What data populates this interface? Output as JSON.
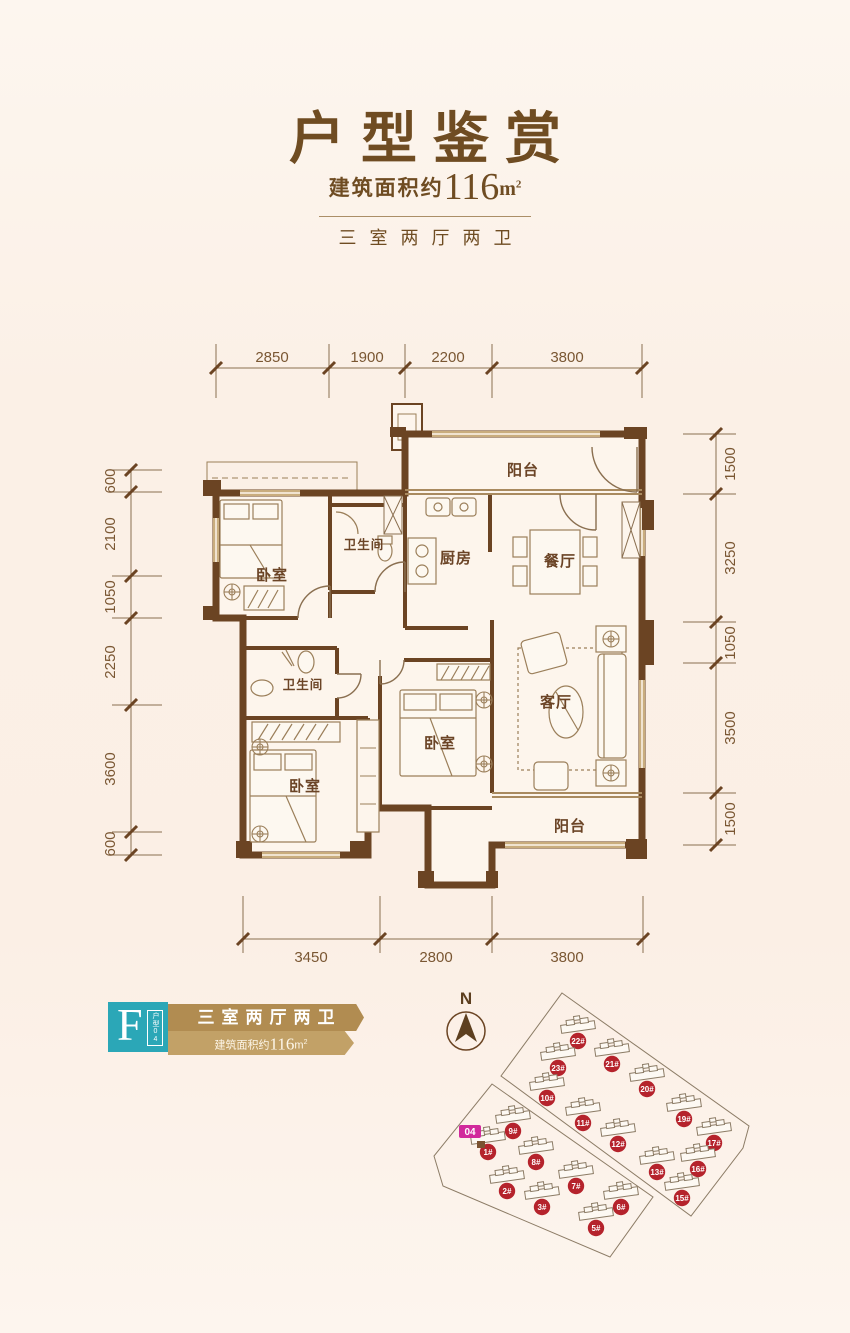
{
  "header": {
    "title": "户型鉴赏",
    "area_prefix": "建筑面积约",
    "area_value": "116",
    "area_unit_base": "m",
    "area_unit_sup": "2",
    "layout_text": "三室两厅两卫"
  },
  "floorplan": {
    "dimensions": {
      "top": [
        "2850",
        "1900",
        "2200",
        "3800"
      ],
      "bottom": [
        "3450",
        "2800",
        "3800"
      ],
      "left": [
        "600",
        "2100",
        "1050",
        "2250",
        "3600",
        "600"
      ],
      "right": [
        "1500",
        "3250",
        "1050",
        "3500",
        "1500"
      ]
    },
    "rooms": [
      {
        "name": "balcony-top",
        "label": "阳台"
      },
      {
        "name": "bedroom-top-left",
        "label": "卧室"
      },
      {
        "name": "bathroom-top",
        "label": "卫生间"
      },
      {
        "name": "kitchen",
        "label": "厨房"
      },
      {
        "name": "dining-room",
        "label": "餐厅"
      },
      {
        "name": "bathroom-middle",
        "label": "卫生间"
      },
      {
        "name": "bedroom-bottom-left",
        "label": "卧室"
      },
      {
        "name": "bedroom-middle",
        "label": "卧室"
      },
      {
        "name": "living-room",
        "label": "客厅"
      },
      {
        "name": "balcony-bottom",
        "label": "阳台"
      }
    ]
  },
  "unit_badge": {
    "letter": "F",
    "tag_vertical": "户型04",
    "layout_text": "三室两厅两卫",
    "area_prefix": "建筑面积约",
    "area_value": "116",
    "area_unit_base": "m",
    "area_unit_sup": "2"
  },
  "site_plan": {
    "north_label": "N",
    "highlight_label": "04",
    "parcels": [
      {
        "points": "562,993 749,1126 743,1148 691,1216 501,1076"
      },
      {
        "points": "492,1084 653,1197 610,1257 443,1186 434,1156"
      }
    ],
    "buildings": [
      {
        "label": "22#",
        "x": 578,
        "y": 1041
      },
      {
        "label": "23#",
        "x": 558,
        "y": 1068
      },
      {
        "label": "21#",
        "x": 612,
        "y": 1064
      },
      {
        "label": "20#",
        "x": 647,
        "y": 1089
      },
      {
        "label": "10#",
        "x": 547,
        "y": 1098
      },
      {
        "label": "11#",
        "x": 583,
        "y": 1123
      },
      {
        "label": "19#",
        "x": 684,
        "y": 1119
      },
      {
        "label": "12#",
        "x": 618,
        "y": 1144
      },
      {
        "label": "17#",
        "x": 714,
        "y": 1143
      },
      {
        "label": "13#",
        "x": 657,
        "y": 1172
      },
      {
        "label": "16#",
        "x": 698,
        "y": 1169
      },
      {
        "label": "15#",
        "x": 682,
        "y": 1198
      },
      {
        "label": "9#",
        "x": 513,
        "y": 1131
      },
      {
        "label": "1#",
        "x": 488,
        "y": 1152
      },
      {
        "label": "8#",
        "x": 536,
        "y": 1162
      },
      {
        "label": "2#",
        "x": 507,
        "y": 1191
      },
      {
        "label": "7#",
        "x": 576,
        "y": 1186
      },
      {
        "label": "3#",
        "x": 542,
        "y": 1207
      },
      {
        "label": "6#",
        "x": 621,
        "y": 1207
      },
      {
        "label": "5#",
        "x": 596,
        "y": 1228
      }
    ]
  },
  "colors": {
    "accent_brown": "#6f4c22",
    "wall_dark": "#6b4423",
    "wall_tan": "#c9ad7e",
    "teal": "#2ba7b7",
    "gold_dark": "#b18c51",
    "gold_light": "#c2a167",
    "badge_red": "#b5232c",
    "highlight_magenta": "#d12a9c",
    "background": "#fbf0e6"
  }
}
